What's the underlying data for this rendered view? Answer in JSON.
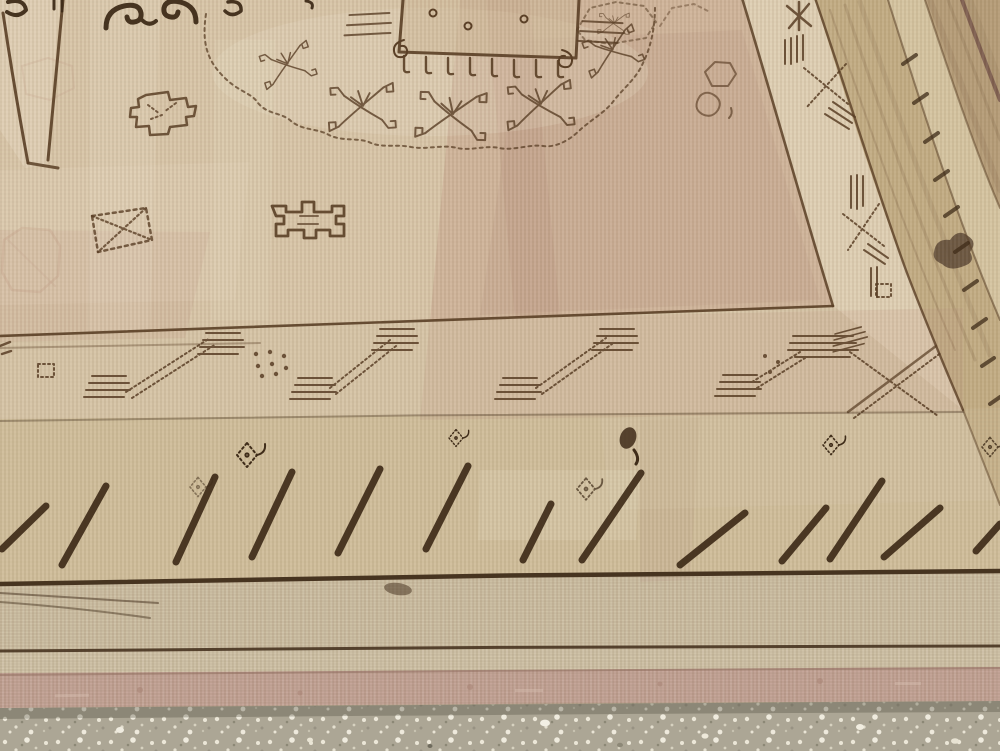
{
  "figure": {
    "alt": "Close-up photograph of a worn antique beige carpet with dark brown geometric and scroll motifs, hook and slash borders, lying on a white-speckled terrazzo floor",
    "subject": "antique Khotan-style carpet, corner detail seen in perspective",
    "surface": "terrazzo floor with white speckles"
  },
  "motifs": {
    "field": [
      "scalloped medallion with angular scroll flowers",
      "central square with comb fringe and dots",
      "dark cloud-scroll pair",
      "stepped cross",
      "crossed-diagonal square",
      "angular fret"
    ],
    "inner_border": "diagonal comb-hook runners with dot clusters and corner X of parallel lines",
    "outer_border": "row of thick diagonal slashes with small hooked diamond devices",
    "side_border": "slanted stripe bands with crossed-line motifs and a column of short dashes",
    "end_finish": "plain woven end bands with thin brown stripes and a rose-pink selvedge"
  },
  "palette": {
    "field_base": "#d8c5a8",
    "field_light": "#e8dcc2",
    "square_tint": "#cdb795",
    "pink_wash": "#b98f7a",
    "wear_light": "#efe4cc",
    "hook_band": "#d6c3a4",
    "slash_band": "#cfbd99",
    "end_band": "#ccbea2",
    "end_strip": "#cfc2a6",
    "pink_band": "#c2a294",
    "pink_mottle": "#a57f72",
    "floor": "#aca695",
    "side_olive": "#c0a87e",
    "side_light": "#d5c4a0",
    "side_outer": "#b59c77",
    "side_streak": "#9c8260",
    "side_purple": "#6e4b43",
    "ink": "#5a3f26",
    "ink_dark": "#3f2c19",
    "ink_faint": "#8a6b4d",
    "ghost": "#c09a86",
    "stain": "#55412f"
  }
}
